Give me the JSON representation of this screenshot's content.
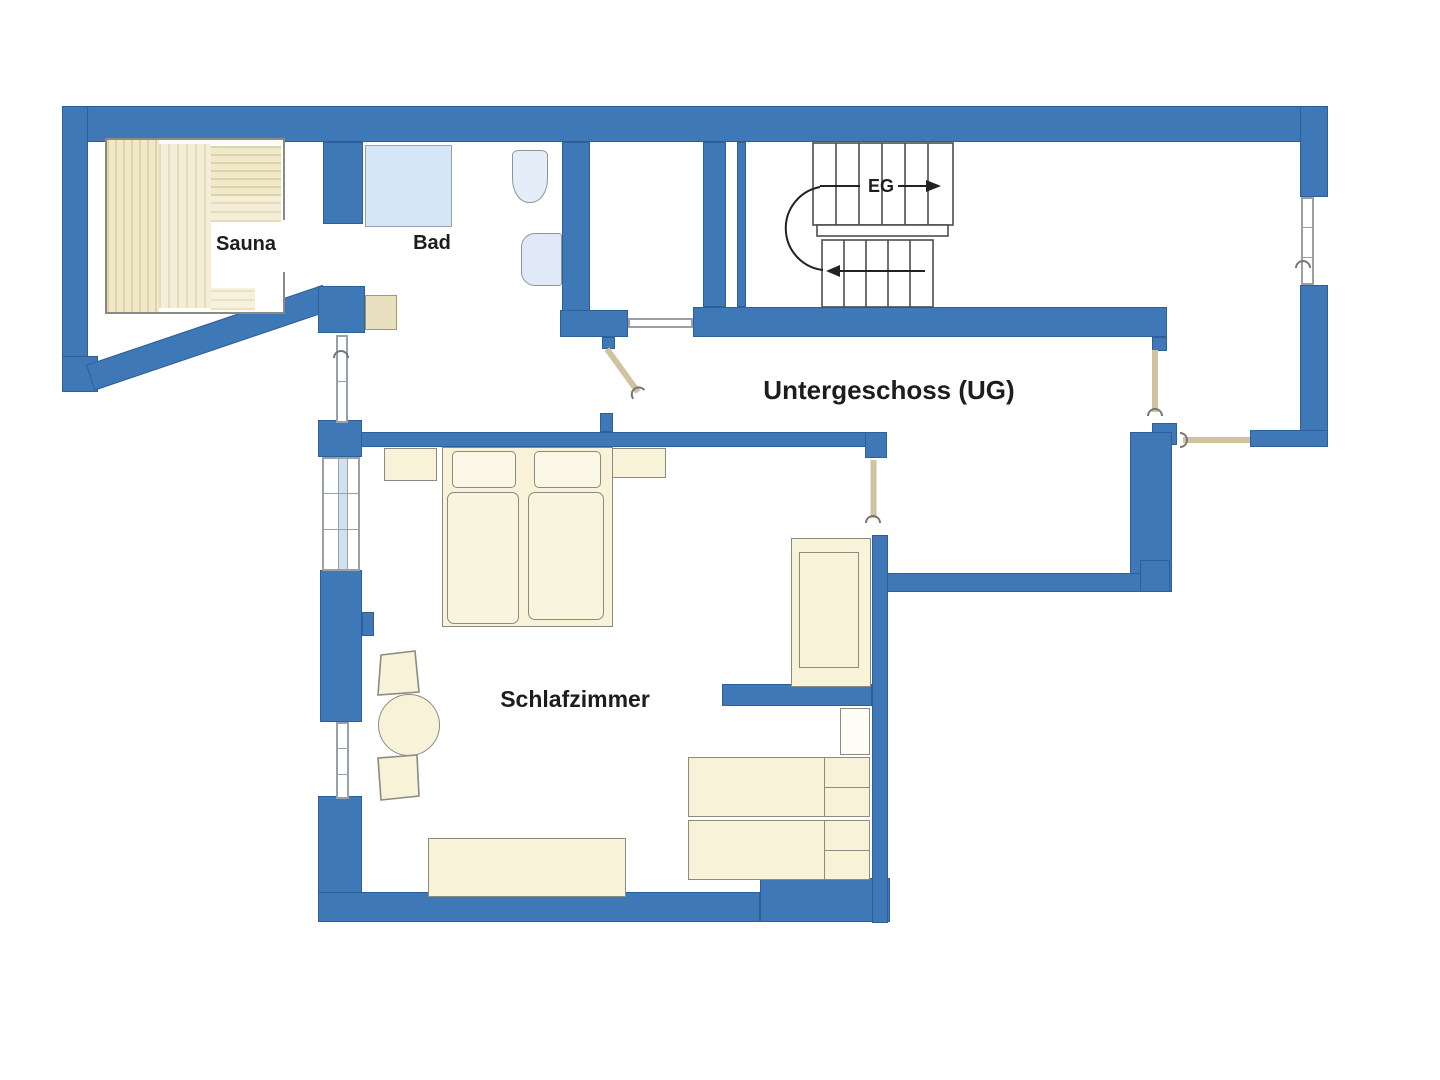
{
  "floor_plan": {
    "floor_label": "Untergeschoss (UG)",
    "stairs": {
      "label": "EG"
    },
    "rooms": [
      {
        "name": "sauna",
        "label": "Sauna"
      },
      {
        "name": "bad",
        "label": "Bad"
      },
      {
        "name": "schlafzimmer",
        "label": "Schlafzimmer"
      }
    ],
    "icons": [
      "sauna-bench-icon",
      "shower-icon",
      "toilet-icon",
      "sink-icon",
      "staircase-icon",
      "stair-arrow-icon",
      "door-leaf-icon",
      "door-swing-hook-icon",
      "window-icon",
      "double-bed-icon",
      "pillow-icon",
      "nightstand-icon",
      "round-table-icon",
      "chair-icon",
      "dresser-icon",
      "sofa-icon",
      "side-table-icon",
      "single-bed-icon"
    ],
    "colors": {
      "wall": "#3e78b6",
      "wall_edge": "#2e5f98",
      "furniture_fill": "#f7f2d8",
      "furniture_border": "#8b8b82",
      "fixture_fill": "#dfeaf6",
      "shower_fill": "#d5e6f6",
      "bench_wood": "#efe8c9",
      "door_leaf": "#d2c3a0",
      "line": "#444444",
      "text": "#1d1d1d",
      "background": "#ffffff"
    }
  }
}
